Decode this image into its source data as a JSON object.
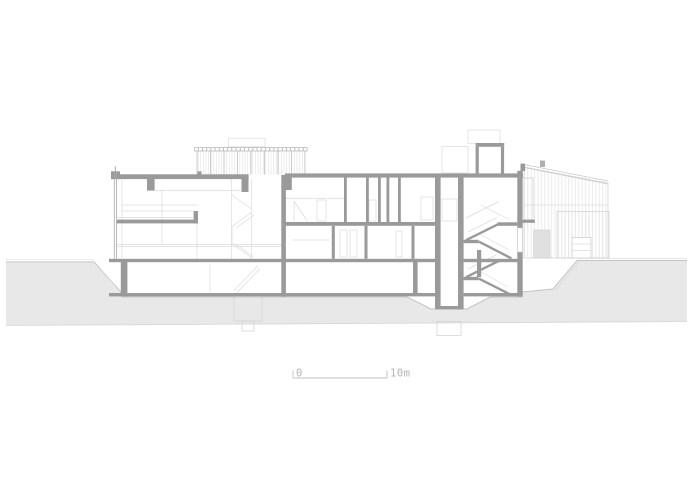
{
  "drawing": {
    "type": "architectural-cross-section",
    "scale_bar": {
      "label_start": "0",
      "label_end": "10m"
    },
    "colors": {
      "cut_elements": "#9a9a9a",
      "earth_fill": "#e8e8e8",
      "earth_edge": "#c4c4c4",
      "background_lines": "#dcdcdc",
      "facade_lines": "#a9a9a9",
      "scale_text": "#b4b4b4",
      "paper": "#ffffff"
    }
  }
}
